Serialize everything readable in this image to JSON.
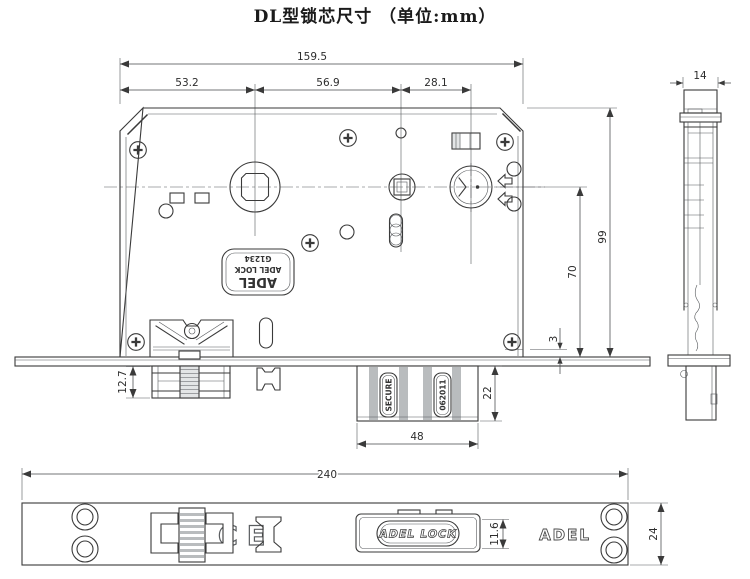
{
  "title": "DL型锁芯尺寸 （单位:mm）",
  "front_view": {
    "dims": {
      "overall_width": "159.5",
      "left_segment": "53.2",
      "middle_segment": "56.9",
      "right_segment": "28.1",
      "height_overall": "99",
      "cylinder_to_faceplate": "70",
      "faceplate_offset": "3",
      "latch_depth": "12.7",
      "deadbolt_height": "22",
      "deadbolt_width": "48"
    },
    "body_stamp": {
      "line1": "ADEL",
      "line2": "ADEL LOCK",
      "line3": "G1234"
    },
    "deadbolt_stamps": {
      "left": "SECURE",
      "right": "062011"
    }
  },
  "side_view": {
    "dims": {
      "thickness": "14"
    }
  },
  "faceplate_view": {
    "dims": {
      "length": "240",
      "width": "24",
      "bolt_plate_height": "11.6"
    },
    "ce_mark": "CE",
    "deadbolt_badge": "ADEL LOCK",
    "brand": "ADEL"
  },
  "colors": {
    "line": "#3a3a3a",
    "dimension": "#44474a",
    "shade": "#b9bcbe",
    "background": "#ffffff"
  }
}
